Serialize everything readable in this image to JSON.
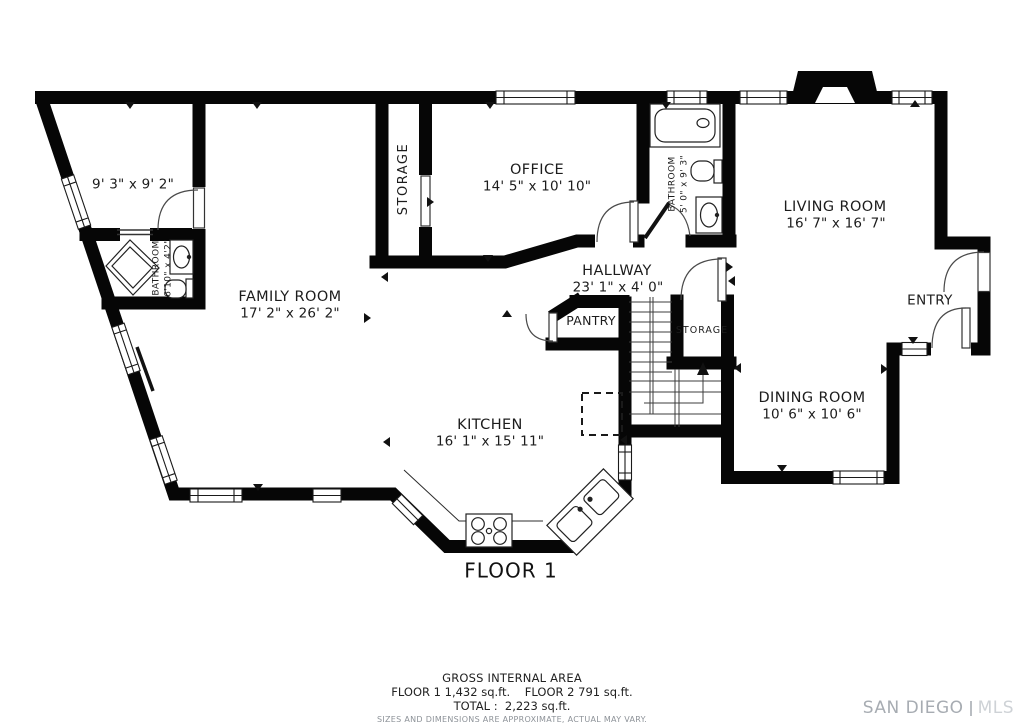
{
  "title": "FLOOR 1",
  "rooms": {
    "corner_room": {
      "dims": "9' 3\" x 9' 2\""
    },
    "bathroom_left": {
      "name": "BATHROOM",
      "dims": "6'10\" x 4'2\""
    },
    "family_room": {
      "name": "FAMILY ROOM",
      "dims": "17' 2\" x 26' 2\""
    },
    "storage_tall": {
      "name": "STORAGE"
    },
    "office": {
      "name": "OFFICE",
      "dims": "14' 5\" x 10' 10\""
    },
    "bathroom_right": {
      "name": "BATHROOM",
      "dims": "5' 0\" x 9' 3\""
    },
    "living_room": {
      "name": "LIVING ROOM",
      "dims": "16' 7\" x 16' 7\""
    },
    "hallway": {
      "name": "HALLWAY",
      "dims": "23' 1\" x 4' 0\""
    },
    "pantry": {
      "name": "PANTRY"
    },
    "storage_small": {
      "name": "STORAGE"
    },
    "entry": {
      "name": "ENTRY"
    },
    "dining_room": {
      "name": "DINING ROOM",
      "dims": "10' 6\" x 10' 6\""
    },
    "kitchen": {
      "name": "KITCHEN",
      "dims": "16' 1\" x 15' 11\""
    }
  },
  "footer": {
    "heading": "GROSS INTERNAL AREA",
    "floors": "FLOOR 1 1,432 sq.ft.    FLOOR 2 791 sq.ft.",
    "total": "TOTAL :  2,223 sq.ft.",
    "disclaimer": "SIZES AND DIMENSIONS ARE APPROXIMATE, ACTUAL MAY VARY."
  },
  "watermark": {
    "brand": "SAN DIEGO",
    "suffix": "MLS"
  },
  "colors": {
    "wall": "#060606",
    "background": "#ffffff",
    "text": "#1c1c1c",
    "muted": "#8d9298"
  }
}
